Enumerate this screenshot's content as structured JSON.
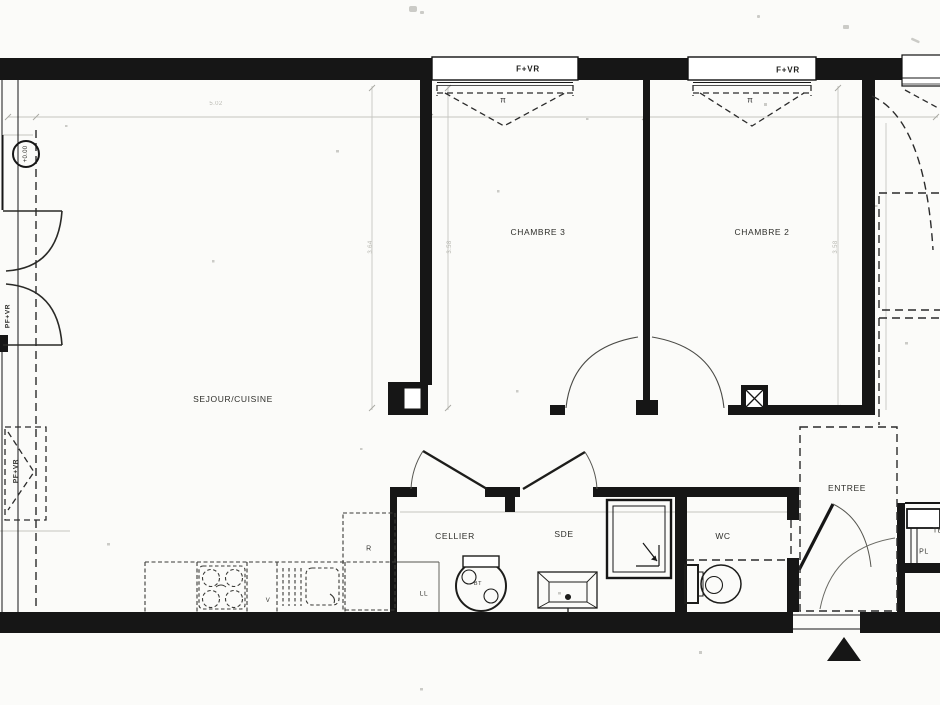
{
  "colors": {
    "paper": "#fbfbf9",
    "ink": "#161616",
    "faint_line": "#c6c6c0",
    "dash_line": "#2b2b2b"
  },
  "plan": {
    "rooms": {
      "sejour": "SEJOUR/CUISINE",
      "chambre3": "CHAMBRE 3",
      "chambre2": "CHAMBRE 2",
      "cellier": "CELLIER",
      "sde": "SDE",
      "wc": "WC",
      "entree": "ENTREE"
    },
    "openings": {
      "window1": "F+VR",
      "window2": "F+VR",
      "french_door": "PF+VR",
      "window_low": "PF+VR",
      "opening_symbol": "π"
    },
    "fixtures": {
      "fridge": "R",
      "washer": "LL",
      "water_heater": "BT",
      "sink": "V",
      "closet": "PL",
      "tech": "TE"
    },
    "markers": {
      "level": "+0.00"
    },
    "dimensions": {
      "sejour_width": "5.02",
      "sejour_depth": "3.64",
      "chambre3_depth": "3.58",
      "chambre2_depth": "3.58"
    }
  }
}
